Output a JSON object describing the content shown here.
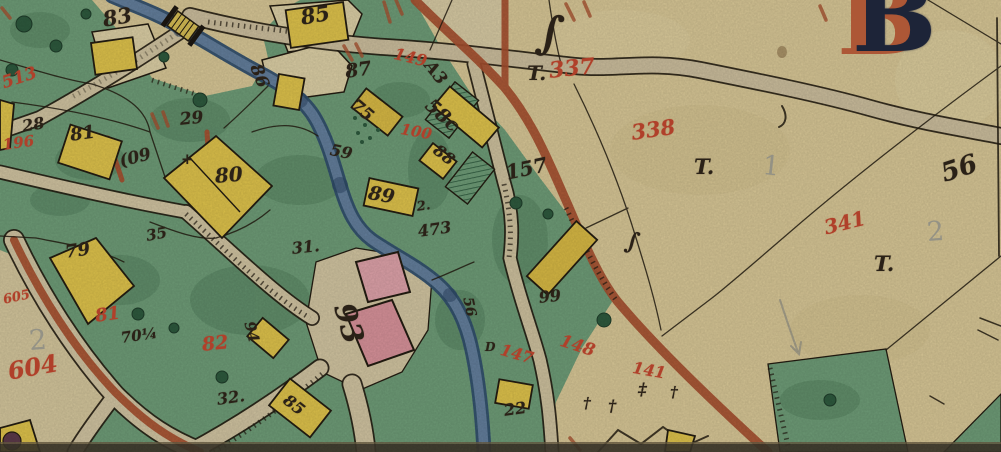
{
  "map": {
    "type": "historical-cadastral-map",
    "sheet_initial": "B",
    "colors": {
      "paper": "#d9c897",
      "field_green": "#6f9d78",
      "green_dark": "#3f6b4d",
      "building_yellow": "#e0c44c",
      "building_pink": "#d9939b",
      "river_blue": "#31506f",
      "river_light": "#647f9d",
      "road_tan": "#cfc29f",
      "boundary_sienna": "#a8502f",
      "ink_black": "#2a2117",
      "ink_red": "#b0402a",
      "pencil_gray": "#8d8d85",
      "initial_blue": "#1d2438",
      "sheet_edge_dark": "#3f3a2c"
    },
    "labels": [
      {
        "text": "83",
        "x": 101,
        "y": 9,
        "size": 21,
        "rot": -10,
        "ink": "ink"
      },
      {
        "text": "85",
        "x": 299,
        "y": 7,
        "size": 21,
        "rot": -10,
        "ink": "ink"
      },
      {
        "text": "86",
        "x": 262,
        "y": 62,
        "size": 17,
        "rot": 68,
        "ink": "ink"
      },
      {
        "text": "87",
        "x": 344,
        "y": 63,
        "size": 19,
        "rot": -8,
        "ink": "ink"
      },
      {
        "text": "75",
        "x": 358,
        "y": 97,
        "size": 17,
        "rot": 40,
        "ink": "ink"
      },
      {
        "text": "58c",
        "x": 434,
        "y": 96,
        "size": 19,
        "rot": 42,
        "ink": "ink"
      },
      {
        "text": "88",
        "x": 440,
        "y": 142,
        "size": 16,
        "rot": 38,
        "ink": "ink"
      },
      {
        "text": "89",
        "x": 370,
        "y": 184,
        "size": 19,
        "rot": 10,
        "ink": "ink"
      },
      {
        "text": "59",
        "x": 332,
        "y": 142,
        "size": 16,
        "rot": 12,
        "ink": "ink"
      },
      {
        "text": "29",
        "x": 179,
        "y": 112,
        "size": 17,
        "rot": -6,
        "ink": "ink"
      },
      {
        "text": "28",
        "x": 21,
        "y": 119,
        "size": 16,
        "rot": -10,
        "ink": "ink"
      },
      {
        "text": "(09",
        "x": 118,
        "y": 154,
        "size": 17,
        "rot": -14,
        "ink": "ink"
      },
      {
        "text": "80",
        "x": 214,
        "y": 166,
        "size": 20,
        "rot": -5,
        "ink": "ink"
      },
      {
        "text": "81",
        "x": 69,
        "y": 127,
        "size": 18,
        "rot": -8,
        "ink": "ink"
      },
      {
        "text": "+",
        "x": 181,
        "y": 152,
        "size": 15,
        "rot": 0,
        "ink": "ink"
      },
      {
        "text": "79",
        "x": 64,
        "y": 244,
        "size": 18,
        "rot": -8,
        "ink": "ink"
      },
      {
        "text": "35",
        "x": 145,
        "y": 229,
        "size": 15,
        "rot": -10,
        "ink": "ink"
      },
      {
        "text": "31.",
        "x": 291,
        "y": 241,
        "size": 16,
        "rot": -6,
        "ink": "ink"
      },
      {
        "text": "2.",
        "x": 416,
        "y": 201,
        "size": 13,
        "rot": -8,
        "ink": "ink"
      },
      {
        "text": "473",
        "x": 417,
        "y": 224,
        "size": 16,
        "rot": -8,
        "ink": "ink"
      },
      {
        "text": "A3",
        "x": 434,
        "y": 58,
        "size": 17,
        "rot": 52,
        "ink": "ink"
      },
      {
        "text": "157",
        "x": 504,
        "y": 163,
        "size": 20,
        "rot": -12,
        "ink": "ink"
      },
      {
        "text": "99",
        "x": 538,
        "y": 290,
        "size": 16,
        "rot": -6,
        "ink": "ink"
      },
      {
        "text": "56",
        "x": 474,
        "y": 296,
        "size": 14,
        "rot": 78,
        "ink": "ink"
      },
      {
        "text": "D",
        "x": 485,
        "y": 341,
        "size": 12,
        "rot": 0,
        "ink": "ink"
      },
      {
        "text": "22",
        "x": 503,
        "y": 403,
        "size": 16,
        "rot": -8,
        "ink": "ink"
      },
      {
        "text": "70¼",
        "x": 120,
        "y": 331,
        "size": 15,
        "rot": -8,
        "ink": "ink"
      },
      {
        "text": "32.",
        "x": 216,
        "y": 392,
        "size": 16,
        "rot": -8,
        "ink": "ink"
      },
      {
        "text": "94",
        "x": 256,
        "y": 320,
        "size": 15,
        "rot": 76,
        "ink": "ink"
      },
      {
        "text": "85",
        "x": 290,
        "y": 392,
        "size": 16,
        "rot": 38,
        "ink": "ink"
      },
      {
        "text": "93",
        "x": 357,
        "y": 300,
        "size": 29,
        "rot": 74,
        "ink": "ink"
      },
      {
        "text": "T.",
        "x": 527,
        "y": 63,
        "size": 20,
        "rot": 0,
        "ink": "ink"
      },
      {
        "text": "T.",
        "x": 694,
        "y": 156,
        "size": 21,
        "rot": 0,
        "ink": "ink"
      },
      {
        "text": "T.",
        "x": 874,
        "y": 253,
        "size": 21,
        "rot": 0,
        "ink": "ink"
      },
      {
        "text": "56",
        "x": 938,
        "y": 162,
        "size": 26,
        "rot": -18,
        "ink": "ink"
      },
      {
        "text": "∫",
        "x": 540,
        "y": 8,
        "size": 46,
        "rot": 8,
        "ink": "ink"
      },
      {
        "text": "∫",
        "x": 628,
        "y": 228,
        "size": 24,
        "rot": 12,
        "ink": "ink"
      },
      {
        "text": "†",
        "x": 583,
        "y": 396,
        "size": 15,
        "rot": 0,
        "ink": "ink"
      },
      {
        "text": "†",
        "x": 608,
        "y": 398,
        "size": 16,
        "rot": 0,
        "ink": "ink"
      },
      {
        "text": "‡",
        "x": 638,
        "y": 382,
        "size": 17,
        "rot": 0,
        "ink": "ink"
      },
      {
        "text": "†",
        "x": 670,
        "y": 385,
        "size": 15,
        "rot": 0,
        "ink": "ink"
      },
      {
        "text": "337",
        "x": 548,
        "y": 60,
        "size": 22,
        "rot": -6,
        "ink": "red"
      },
      {
        "text": "338",
        "x": 630,
        "y": 122,
        "size": 21,
        "rot": -8,
        "ink": "red"
      },
      {
        "text": "341",
        "x": 822,
        "y": 218,
        "size": 20,
        "rot": -14,
        "ink": "red"
      },
      {
        "text": "149",
        "x": 396,
        "y": 46,
        "size": 16,
        "rot": 14,
        "ink": "red"
      },
      {
        "text": "100",
        "x": 402,
        "y": 122,
        "size": 15,
        "rot": 10,
        "ink": "red"
      },
      {
        "text": "147",
        "x": 503,
        "y": 342,
        "size": 16,
        "rot": 16,
        "ink": "red"
      },
      {
        "text": "148",
        "x": 563,
        "y": 333,
        "size": 17,
        "rot": 18,
        "ink": "red"
      },
      {
        "text": "141",
        "x": 634,
        "y": 360,
        "size": 16,
        "rot": 10,
        "ink": "red"
      },
      {
        "text": "82",
        "x": 201,
        "y": 336,
        "size": 19,
        "rot": -6,
        "ink": "red"
      },
      {
        "text": "81",
        "x": 94,
        "y": 308,
        "size": 18,
        "rot": -8,
        "ink": "red"
      },
      {
        "text": "604",
        "x": 6,
        "y": 360,
        "size": 24,
        "rot": -10,
        "ink": "red"
      },
      {
        "text": "605",
        "x": 2,
        "y": 294,
        "size": 13,
        "rot": -12,
        "ink": "red"
      },
      {
        "text": "196",
        "x": 2,
        "y": 138,
        "size": 15,
        "rot": -8,
        "ink": "red"
      },
      {
        "text": "513",
        "x": 0,
        "y": 76,
        "size": 17,
        "rot": -18,
        "ink": "red"
      },
      {
        "text": "1",
        "x": 764,
        "y": 152,
        "size": 27,
        "rot": 6,
        "ink": "pencil"
      },
      {
        "text": "2",
        "x": 926,
        "y": 219,
        "size": 27,
        "rot": -4,
        "ink": "pencil"
      },
      {
        "text": "2",
        "x": 28,
        "y": 327,
        "size": 28,
        "rot": -4,
        "ink": "pencil"
      },
      {
        "text": "B",
        "x": 852,
        "y": -34,
        "size": 100,
        "rot": 0,
        "ink": "initial"
      }
    ]
  }
}
